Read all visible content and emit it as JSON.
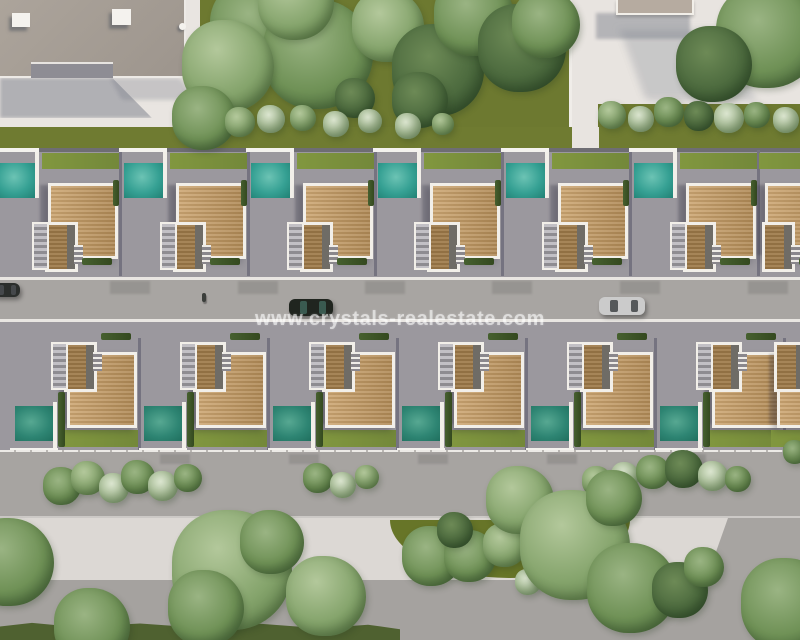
{
  "watermark": {
    "text": "www.crystals-realestate.com"
  },
  "palette": {
    "plaza": "#e8e4e0",
    "olive": "#6d7930",
    "oliveStrip": "#6f7b31",
    "wedge": "#677528",
    "lotGray": "#9b989e",
    "road": "#a8a5a2",
    "sidewalk": "#a7a4a1",
    "path": "#dcd8d4",
    "bottom": "#a5a29f",
    "darkGrass": "#4f6130",
    "poolA": "#35a093",
    "poolB": "#2e8573",
    "white": "#f2efe9",
    "wall": "#6e6d73",
    "curb": "#e9e6e2",
    "roofSmall": "#b6aba0"
  },
  "villas": {
    "row1": {
      "units": [
        {
          "x": -6
        },
        {
          "x": 122
        },
        {
          "x": 249
        },
        {
          "x": 376
        },
        {
          "x": 504
        },
        {
          "x": 632
        },
        {
          "x": 711,
          "variant": "no-pool"
        }
      ]
    },
    "row2": {
      "units": [
        {
          "x": 13
        },
        {
          "x": 142
        },
        {
          "x": 271
        },
        {
          "x": 400
        },
        {
          "x": 529
        },
        {
          "x": 658
        },
        {
          "x": 723,
          "variant": "no-pool"
        }
      ]
    }
  },
  "vehicles": [
    {
      "name": "car-black",
      "x": 289,
      "y": 299,
      "w": 44,
      "h": 17,
      "body": "#20251f",
      "glass": "#3a5a50"
    },
    {
      "name": "car-silver",
      "x": 599,
      "y": 297,
      "w": 46,
      "h": 18,
      "body": "#cbcbcb",
      "glass": "#55585a"
    },
    {
      "name": "car-parked-edge",
      "x": -8,
      "y": 283,
      "w": 28,
      "h": 14,
      "body": "#2b2e2c",
      "glass": "#45484b"
    }
  ],
  "road_shadow_x": [
    110,
    238,
    365,
    492,
    620,
    748
  ],
  "sidewalk_shadow_x": [
    160,
    289,
    418,
    547,
    676
  ],
  "trees": [
    [
      258,
      28,
      48,
      "mid"
    ],
    [
      318,
      54,
      55,
      "mid"
    ],
    [
      296,
      2,
      38,
      "light"
    ],
    [
      388,
      26,
      36,
      "light"
    ],
    [
      438,
      70,
      46,
      "dark"
    ],
    [
      474,
      16,
      40,
      "mid"
    ],
    [
      522,
      48,
      44,
      "dark"
    ],
    [
      546,
      24,
      34,
      "mid"
    ],
    [
      768,
      36,
      52,
      "mid"
    ],
    [
      714,
      64,
      38,
      "dark"
    ],
    [
      228,
      66,
      46,
      "light"
    ],
    [
      204,
      118,
      32,
      "mid"
    ],
    [
      420,
      100,
      28,
      "dark"
    ],
    [
      355,
      98,
      20,
      "dark"
    ],
    [
      240,
      122,
      15,
      "light"
    ],
    [
      271,
      119,
      14,
      "pale"
    ],
    [
      303,
      118,
      13,
      "light"
    ],
    [
      336,
      124,
      13,
      "pale"
    ],
    [
      370,
      121,
      12,
      "pale"
    ],
    [
      408,
      126,
      13,
      "pale"
    ],
    [
      443,
      124,
      11,
      "light"
    ],
    [
      612,
      115,
      14,
      "light"
    ],
    [
      641,
      119,
      13,
      "pale"
    ],
    [
      669,
      112,
      15,
      "mid"
    ],
    [
      699,
      116,
      15,
      "dark"
    ],
    [
      729,
      118,
      15,
      "pale"
    ],
    [
      757,
      115,
      13,
      "mid"
    ],
    [
      786,
      120,
      13,
      "pale"
    ],
    [
      62,
      486,
      19,
      "mid"
    ],
    [
      88,
      478,
      17,
      "light"
    ],
    [
      114,
      488,
      15,
      "pale"
    ],
    [
      138,
      477,
      17,
      "mid"
    ],
    [
      163,
      486,
      15,
      "pale"
    ],
    [
      188,
      478,
      14,
      "mid"
    ],
    [
      318,
      478,
      15,
      "mid"
    ],
    [
      343,
      485,
      13,
      "pale"
    ],
    [
      367,
      477,
      12,
      "light"
    ],
    [
      597,
      481,
      15,
      "light"
    ],
    [
      625,
      476,
      14,
      "pale"
    ],
    [
      653,
      472,
      17,
      "mid"
    ],
    [
      684,
      469,
      19,
      "dark"
    ],
    [
      713,
      476,
      15,
      "pale"
    ],
    [
      738,
      479,
      13,
      "mid"
    ],
    [
      795,
      452,
      12,
      "mid"
    ],
    [
      432,
      556,
      30,
      "mid"
    ],
    [
      470,
      556,
      26,
      "mid"
    ],
    [
      455,
      530,
      18,
      "dark"
    ],
    [
      505,
      545,
      22,
      "light"
    ],
    [
      535,
      532,
      12,
      "light"
    ],
    [
      528,
      582,
      13,
      "pale"
    ],
    [
      10,
      562,
      44,
      "mid"
    ],
    [
      92,
      626,
      38,
      "mid"
    ],
    [
      232,
      570,
      60,
      "light"
    ],
    [
      206,
      608,
      38,
      "mid"
    ],
    [
      272,
      542,
      32,
      "mid"
    ],
    [
      326,
      596,
      40,
      "light"
    ],
    [
      520,
      500,
      34,
      "light"
    ],
    [
      575,
      545,
      55,
      "light"
    ],
    [
      632,
      588,
      45,
      "mid"
    ],
    [
      614,
      498,
      28,
      "mid"
    ],
    [
      680,
      590,
      28,
      "dark"
    ],
    [
      704,
      567,
      20,
      "mid"
    ],
    [
      787,
      604,
      46,
      "mid"
    ]
  ]
}
